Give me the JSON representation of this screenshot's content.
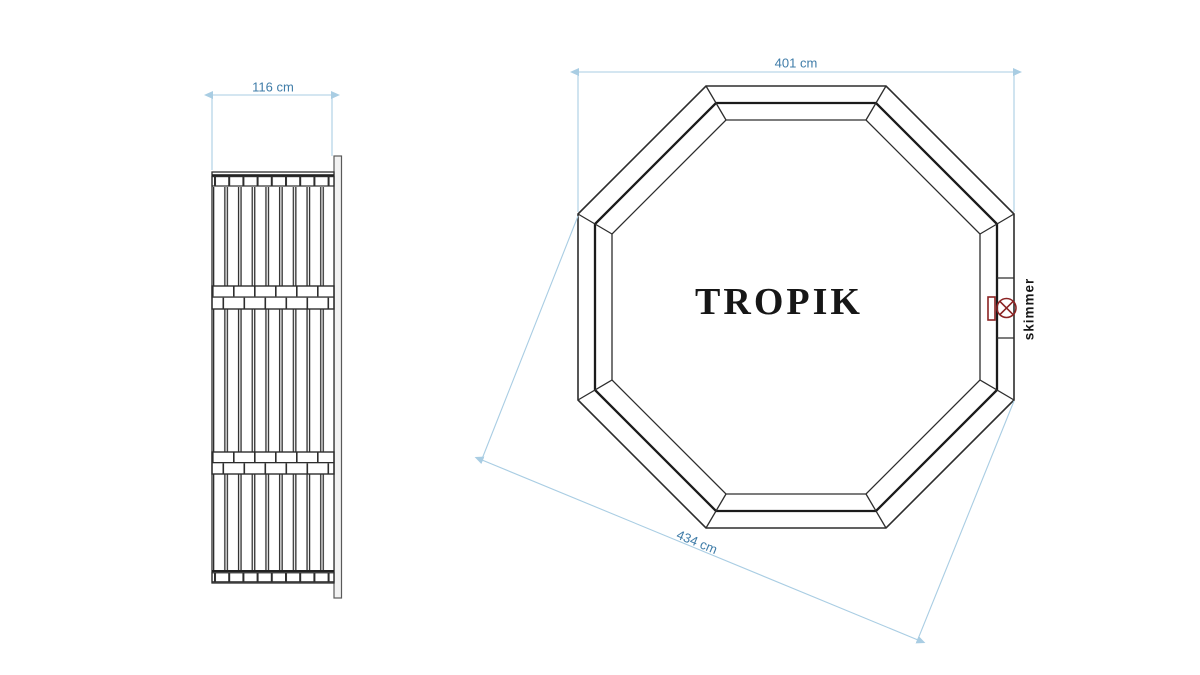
{
  "drawing": {
    "model_label": "TROPIK",
    "skimmer_label": "skimmer",
    "side_view": {
      "width_label": "116 cm"
    },
    "top_view": {
      "width_label": "401 cm",
      "diagonal_label": "434 cm"
    },
    "colors": {
      "drawing_line": "#2d2d2d",
      "dimension_line": "#a9cde3",
      "dimension_text": "#3f7ca8",
      "skimmer_icon": "#8b2323",
      "label_text": "#161616",
      "background": "#ffffff"
    }
  }
}
